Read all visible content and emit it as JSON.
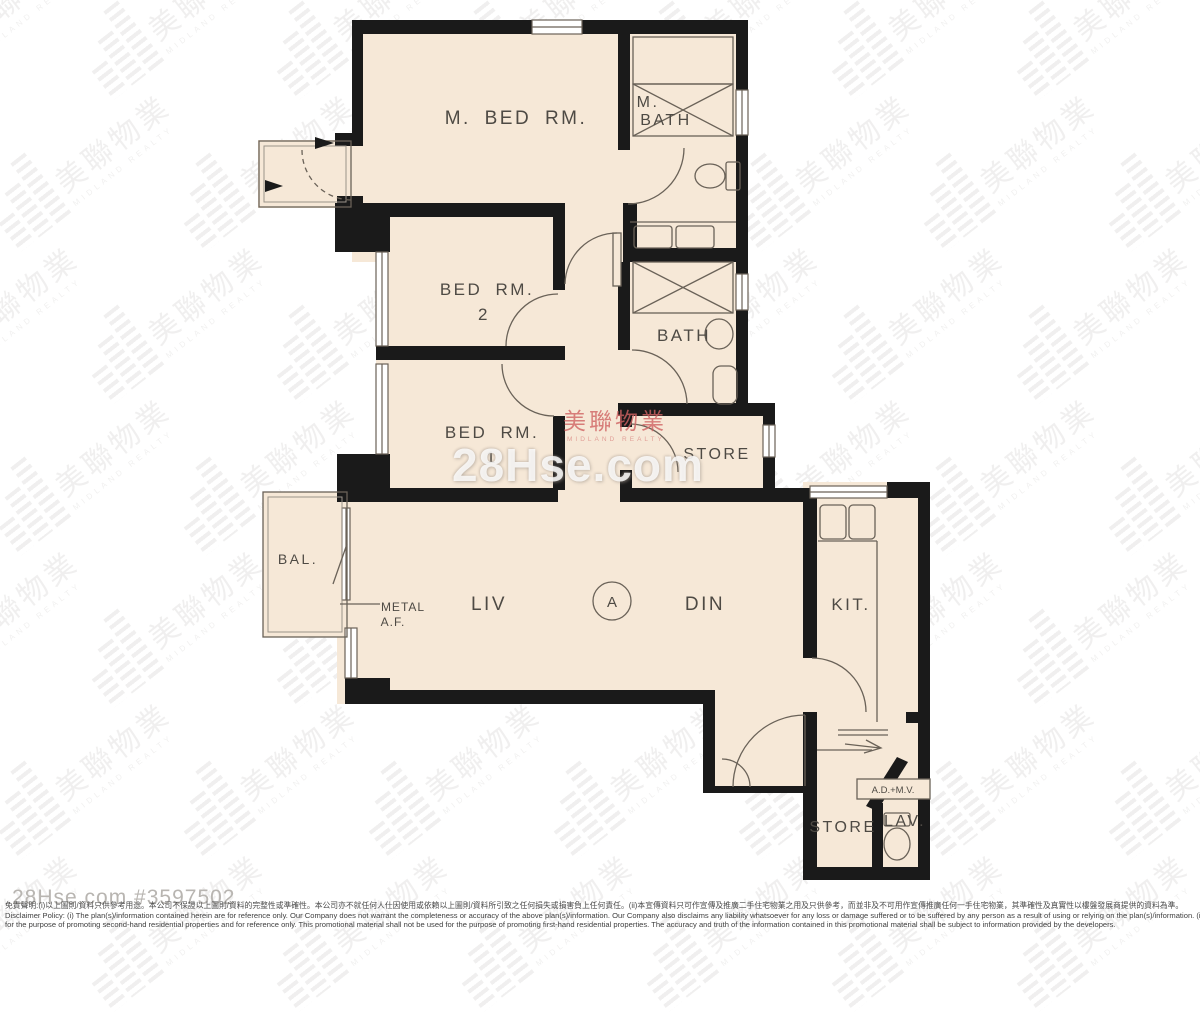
{
  "watermark": {
    "brand_cjk": "美聯物業",
    "brand_latin": "MIDLAND REALTY",
    "site": "28Hse.com",
    "listing_ref": "28Hse.com #3597502"
  },
  "labels": {
    "m_bed": "M. BED RM.",
    "m_bath_l1": "M.",
    "m_bath_l2": "BATH",
    "bed2_l1": "BED RM.",
    "bed2_l2": "2",
    "bed1_l1": "BED RM.",
    "bed1_l2": "1",
    "bath": "BATH",
    "store_mid": "STORE",
    "unit": "A",
    "liv": "LIV",
    "din": "DIN",
    "kit": "KIT.",
    "bal": "BAL.",
    "metal_l1": "METAL",
    "metal_l2": "A.F.",
    "store_btm": "STORE",
    "lav": "LAV.",
    "ad_mv": "A.D.+M.V."
  },
  "footer": {
    "line1_zh": "免責聲明:(i)以上圖則/資料只供參考用途。本公司不保證以上圖則/資料的完整性或準確性。本公司亦不就任何人仕因使用或依賴以上圖則/資料所引致之任何損失或損害負上任何責任。(ii)本宣傳資料只可作宣傳及推廣二手住宅物業之用及只供參考，而並非及不可用作宣傳推廣任何一手住宅物業，其準確性及真實性以樓盤發展商提供的資料為準。",
    "line2_en": "Disclaimer Policy: (i) The plan(s)/information contained herein are for reference only. Our Company does not warrant the completeness or accuracy of the above plan(s)/information. Our Company also disclaims any liability whatsoever for any loss or damage suffered or to be suffered by any person as a result of using or relying on the plan(s)/information. (ii) This promotional material is",
    "line3_en": "for the purpose of promoting second-hand residential properties and for reference only. This promotional material shall not be used for the purpose of promoting first-hand residential properties. The accuracy and truth of the information contained in this promotional material shall be subject to information provided by the developers."
  },
  "colors": {
    "room_fill": "#f6e8d7",
    "wall": "#1a1a1a",
    "fixture_line": "#6a6258",
    "label_text": "#4e4a44",
    "watermark_pink": "#cc7f7f",
    "watermark_gray": "#8a8680"
  }
}
